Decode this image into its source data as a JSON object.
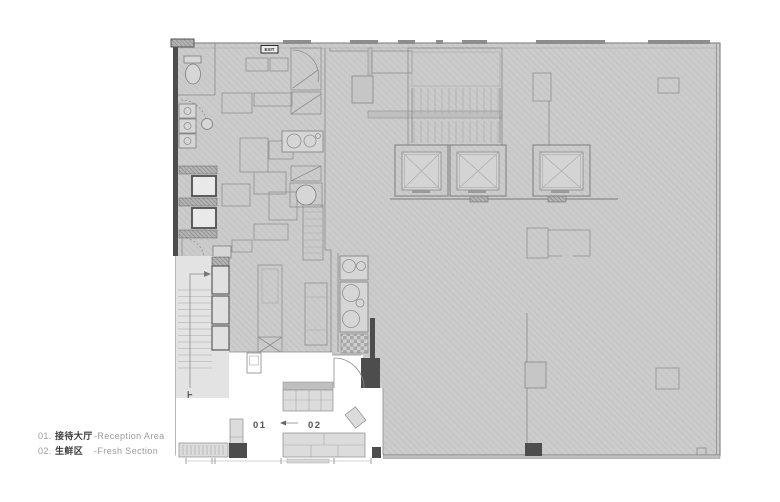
{
  "plan": {
    "exit_sign": "EXIT",
    "stair_up_label": "上",
    "room_labels": {
      "reception": "01",
      "fresh": "02"
    }
  },
  "legend": {
    "items": [
      {
        "num": "01.",
        "zh": "接待大厅",
        "en": "-Reception Area"
      },
      {
        "num": "02.",
        "zh": "生鲜区",
        "en": "-Fresh Section"
      }
    ]
  },
  "colors": {
    "page_bg": "#ffffff",
    "hatch_fill": "#cbcbcb",
    "hatch_line": "#bdbdbd",
    "wall_dark": "#4d4d4d",
    "stair_fill": "#e3e3e3",
    "shelf_fill": "#dcdcdc",
    "line": "#8a8a8a",
    "text_gray": "#9b9b9b",
    "text_dark": "#3d3d3d"
  }
}
